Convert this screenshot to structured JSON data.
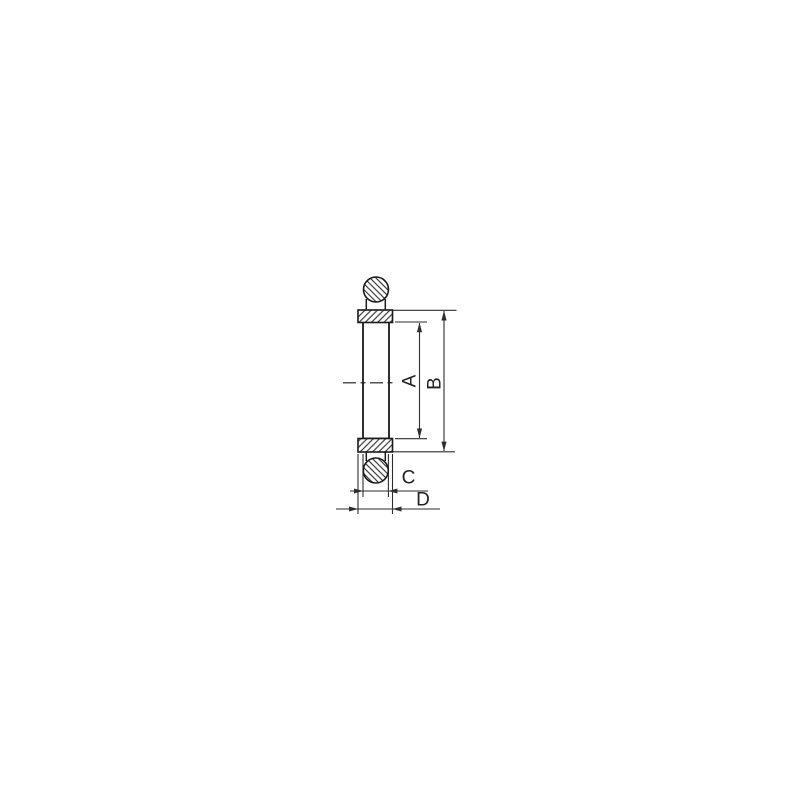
{
  "drawing": {
    "type": "technical-cross-section-drawing",
    "part_semantics": [
      "o-ring-cross-section",
      "centering-ring-section",
      "ring-body",
      "centerline"
    ],
    "labels": {
      "dim_a": "A",
      "dim_b": "B",
      "dim_c": "C",
      "dim_d": "D"
    },
    "colors": {
      "background": "#ffffff",
      "part_line": "#1a1a1a",
      "dimension_line": "#2e2e2e",
      "label_text": "#222222"
    }
  }
}
